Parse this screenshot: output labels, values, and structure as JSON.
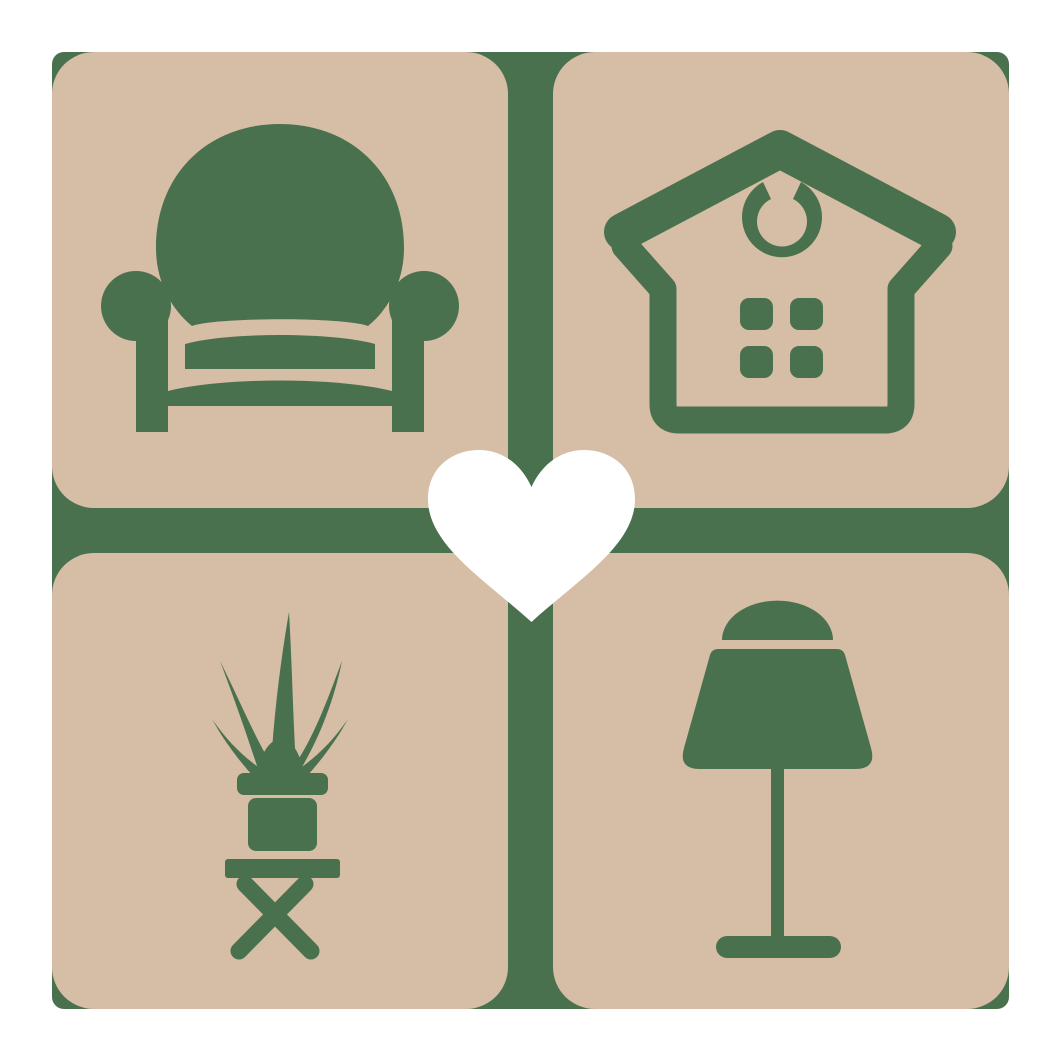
{
  "logo": {
    "title": "Furniture and home decor logo",
    "description": "Four rounded tiles with home furnishing icons joined by a green cross, white heart in the center",
    "colors": {
      "page_background": "#ffffff",
      "tile": "#d6bda5",
      "icon": "#4a714e",
      "heart": "#ffffff"
    },
    "tiles": [
      {
        "position": "top-left",
        "icon": "armchair-icon",
        "label": "armchair"
      },
      {
        "position": "top-right",
        "icon": "house-icon",
        "label": "house with hanging ornament and four-pane window"
      },
      {
        "position": "bottom-left",
        "icon": "potted-plant-icon",
        "label": "potted plant on folding stool"
      },
      {
        "position": "bottom-right",
        "icon": "table-lamp-icon",
        "label": "table lamp"
      }
    ],
    "center_icon": "heart-icon"
  }
}
